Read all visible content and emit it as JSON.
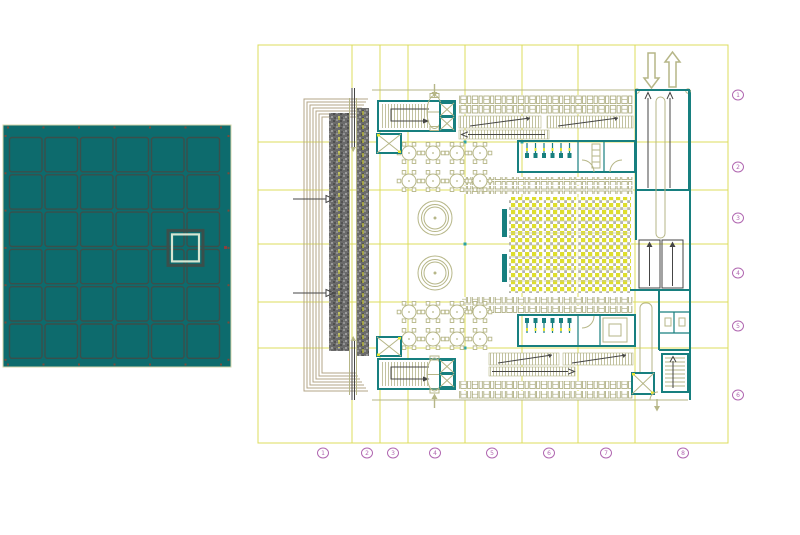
{
  "colors": {
    "bg": "#ffffff",
    "grid-yellow": "#dcdc5c",
    "accent-yellow": "#e4e432",
    "olive": "#b6b687",
    "tan": "#b3a487",
    "teal": "#177f7f",
    "teal-bright": "#2aa3a3",
    "dark": "#454545",
    "hatch-gray": "#6a6a6a",
    "purple": "#b168b1",
    "seat-yellow": "#dede2e",
    "seat-gray": "#b5b5ad",
    "overview-fill": "#0d6b6d",
    "overview-line": "#3a4f4b",
    "overview-border": "#d4d4aa",
    "overview-highlight": "#d6e6d2",
    "overview-dot": "#7a4a3a"
  },
  "overview_panel": {
    "rows": 6,
    "cols": 6,
    "highlight": {
      "col_boundary": 5,
      "row_boundary": 3
    }
  },
  "floor_plan": {
    "bubbles_bottom": [
      "1",
      "2",
      "3",
      "4",
      "5",
      "6",
      "7",
      "8"
    ],
    "bubbles_right": [
      "1",
      "2",
      "3",
      "4",
      "5",
      "6"
    ]
  }
}
